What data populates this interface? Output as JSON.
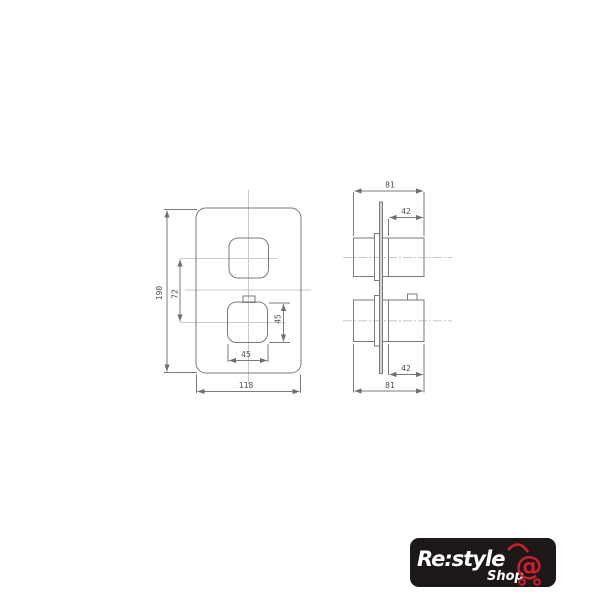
{
  "canvas": {
    "background": "#ffffff"
  },
  "drawing": {
    "stroke_color": "#7a7a7a",
    "centerline_color": "#c9c9c9",
    "label_color": "#4f4f4f",
    "front": {
      "height": "190",
      "knob_spacing": "72",
      "knob_height": "45",
      "knob_width": "45",
      "width": "118"
    },
    "side": {
      "total_depth_top": "81",
      "knob_depth_top": "42",
      "knob_depth_bottom": "42",
      "total_depth_bottom": "81"
    }
  },
  "logo": {
    "brand": "Re:style",
    "sub": "Shop",
    "at": "@",
    "background": "#1c1818",
    "accent": "#c9202c",
    "text_color": "#ffffff"
  }
}
